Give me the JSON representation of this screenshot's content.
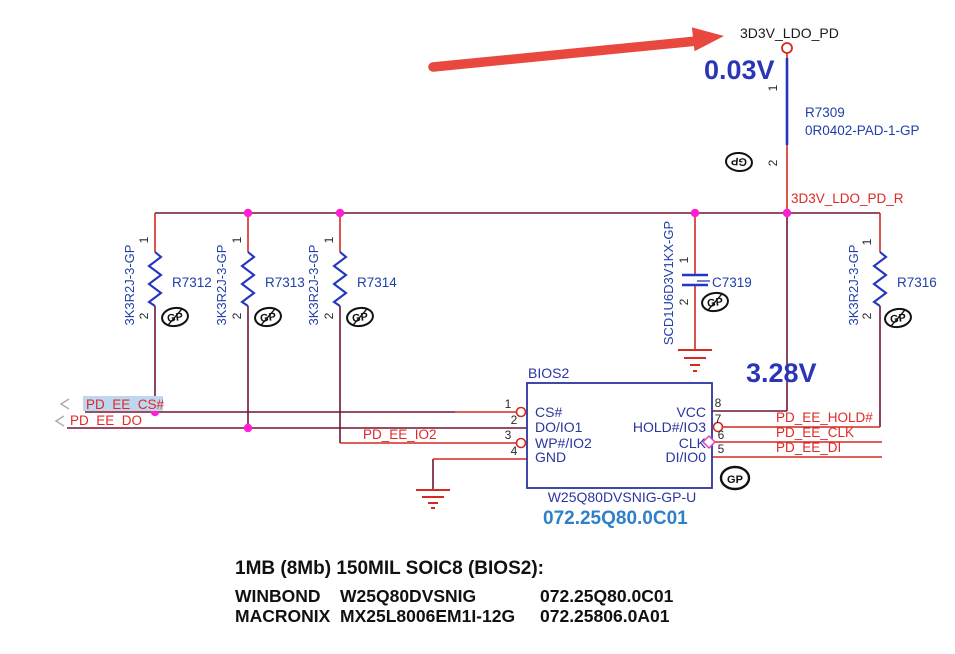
{
  "top": {
    "net_ldo_pd": "3D3V_LDO_PD",
    "net_ldo_pd_r": "3D3V_LDO_PD_R",
    "voltage_probe_top": "0.03V",
    "voltage_probe_vcc": "3.28V"
  },
  "nets": {
    "cs": "PD_EE_CS#",
    "do": "PD_EE_DO",
    "io2": "PD_EE_IO2",
    "hold": "PD_EE_HOLD#",
    "clk": "PD_EE_CLK",
    "di": "PD_EE_DI"
  },
  "components": {
    "r7309": {
      "ref": "R7309",
      "part": "0R0402-PAD-1-GP"
    },
    "r7312": {
      "ref": "R7312",
      "part": "3K3R2J-3-GP"
    },
    "r7313": {
      "ref": "R7313",
      "part": "3K3R2J-3-GP"
    },
    "r7314": {
      "ref": "R7314",
      "part": "3K3R2J-3-GP"
    },
    "r7316": {
      "ref": "R7316",
      "part": "3K3R2J-3-GP"
    },
    "c7319": {
      "ref": "C7319",
      "part": "SCD1U6D3V1KX-GP"
    }
  },
  "pins": {
    "p1": "1",
    "p2": "2"
  },
  "chip": {
    "designator": "BIOS2",
    "part": "W25Q80DVSNIG-GP-U",
    "internal_pn": "072.25Q80.0C01",
    "pins_left": [
      {
        "num": "1",
        "name": "CS#"
      },
      {
        "num": "2",
        "name": "DO/IO1"
      },
      {
        "num": "3",
        "name": "WP#/IO2"
      },
      {
        "num": "4",
        "name": "GND"
      }
    ],
    "pins_right": [
      {
        "num": "8",
        "name": "VCC"
      },
      {
        "num": "7",
        "name": "HOLD#/IO3"
      },
      {
        "num": "6",
        "name": "CLK"
      },
      {
        "num": "5",
        "name": "DI/IO0"
      }
    ]
  },
  "gp_marker": "GP",
  "notes": {
    "title": "1MB (8Mb) 150MIL SOIC8 (BIOS2):",
    "rows": [
      {
        "vendor": "WINBOND",
        "part": "W25Q80DVSNIG",
        "pn": "072.25Q80.0C01"
      },
      {
        "vendor": "MACRONIX",
        "part": "MX25L8006EM1I-12G",
        "pn": "072.25806.0A01"
      }
    ]
  },
  "colors": {
    "wire_red": "#d42a20",
    "wire_maroon": "#701535",
    "symbol_blue": "#2236c0",
    "label_blue": "#2040a8",
    "chip_blue": "#2b35a0",
    "pn_blue": "#2e80c8",
    "net_red": "#e02828",
    "junction_magenta": "#ff1fd4",
    "highlight_blue": "#bdd7ee",
    "arrow_red": "#e8483e",
    "voltage_blue": "#2a35b8"
  }
}
